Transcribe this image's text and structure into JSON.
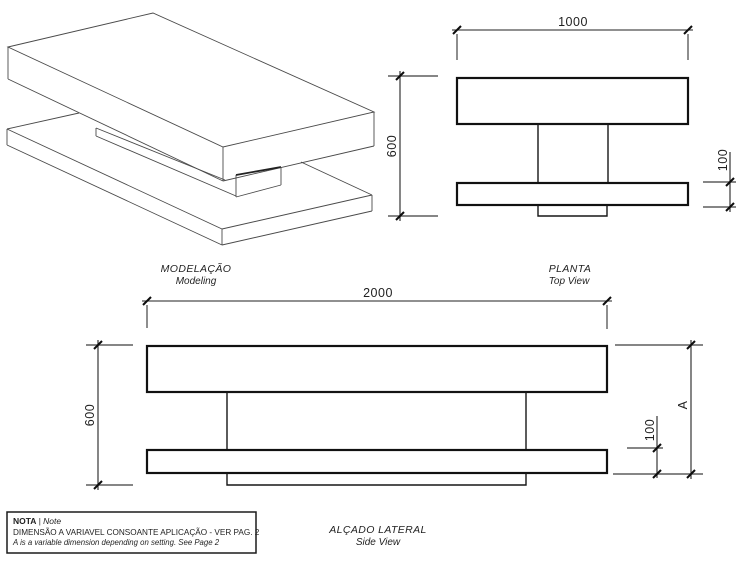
{
  "drawing": {
    "views": {
      "modeling": {
        "title_pt": "MODELAÇÃO",
        "title_en": "Modeling"
      },
      "top_view": {
        "title_pt": "PLANTA",
        "title_en": "Top View",
        "dimensions": {
          "width": "1000",
          "depth": "600",
          "offset": "100"
        }
      },
      "side_view": {
        "title_pt": "ALÇADO LATERAL",
        "title_en": "Side View",
        "dimensions": {
          "length": "2000",
          "height": "600",
          "slab_thickness": "100",
          "variable": "A"
        }
      }
    },
    "note": {
      "label_pt": "NOTA",
      "separator": " | ",
      "label_en": "Note",
      "text_pt": "DIMENSÃO A VARIAVEL CONSOANTE APLICAÇÃO - VER PAG. 2",
      "text_en": "A is a variable dimension depending on setting. See Page 2"
    },
    "colors": {
      "background": "#ffffff",
      "object_line": "#111111",
      "dimension_line": "#222222",
      "extension_line": "#5e5e5e"
    }
  }
}
